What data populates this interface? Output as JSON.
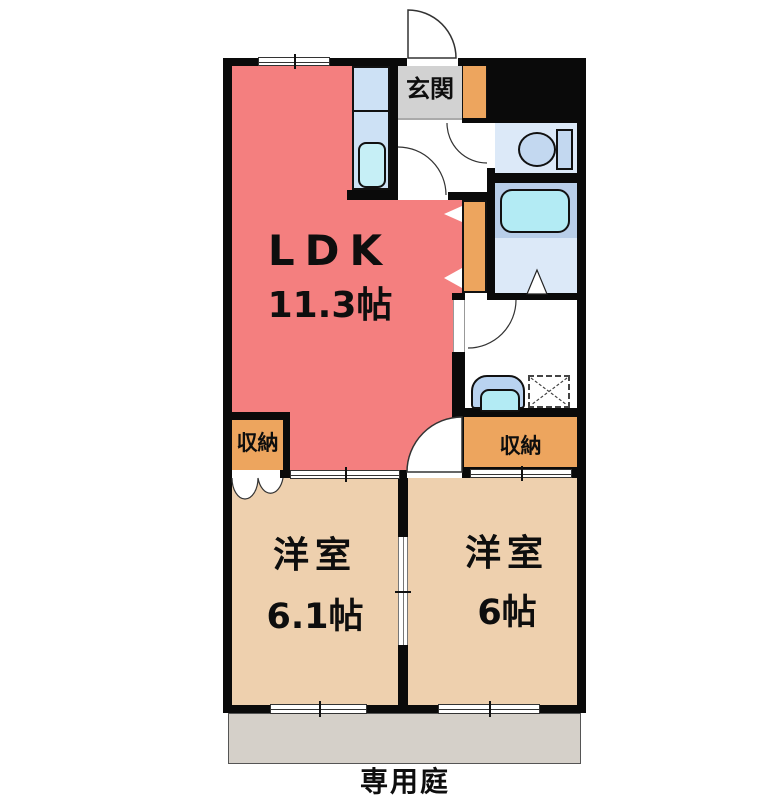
{
  "plan": {
    "type": "apartment-floor-plan",
    "rooms": {
      "ldk": {
        "label": "LDK",
        "size": "11.3帖"
      },
      "bedroom_left": {
        "label": "洋室",
        "size": "6.1帖"
      },
      "bedroom_right": {
        "label": "洋室",
        "size": "6帖"
      },
      "entrance": {
        "label": "玄関"
      },
      "closet_left": {
        "label": "収納"
      },
      "closet_right": {
        "label": "収納"
      },
      "garden": {
        "label": "専用庭"
      }
    },
    "fixtures": [
      "kitchen-sink",
      "toilet",
      "bathtub",
      "bath-folding-door",
      "washbasin",
      "washing-machine-pan"
    ],
    "colors": {
      "wall": "#0a0a0a",
      "ldk": "#f47f7f",
      "bedroom": "#eed0ae",
      "storage": "#eda55e",
      "entrance_floor": "#d2d2d2",
      "garden": "#d5d0c9",
      "kitchen_counter": "#cde1f5",
      "sink": "#c6eff6",
      "toilet_floor": "#dce9f8",
      "toilet_fixture": "#c3d8f0",
      "bath_floor": "#b8cee9",
      "bath_entry_floor": "#dce9f8",
      "bathtub": "#b3ebf4",
      "washbasin_outer": "#b9d3f0",
      "washbasin_bowl": "#b3ebf4"
    }
  }
}
